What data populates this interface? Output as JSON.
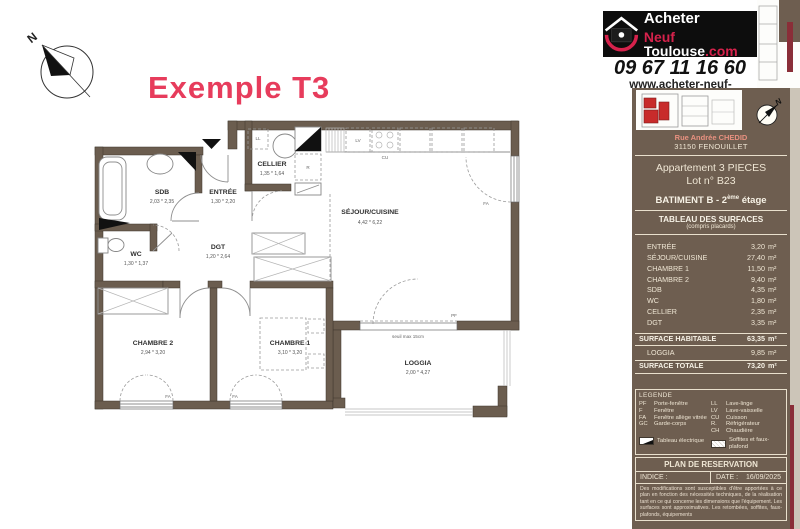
{
  "title": "Exemple T3",
  "colors": {
    "accent_pink": "#e73c5c",
    "logo_red": "#d6224c",
    "panel_brown": "#6e5e50",
    "wall_brown": "#6b5d4f",
    "maroon": "#8a2e38",
    "site_red": "#c82b2b"
  },
  "header": {
    "logo": {
      "line1": "Acheter",
      "line2_red": "Neuf",
      "line2_white": " Toulouse",
      "line2_suffix": ".com"
    },
    "phone": "09 67 11 16 60",
    "website": "www.acheter-neuf-toulouse.com"
  },
  "panel": {
    "address_line1": "Rue Andrée CHEDID",
    "address_line2": "31150 FENOUILLET",
    "apartment_type": "Appartement 3 PIECES",
    "lot": "Lot n° B23",
    "building_prefix": "BATIMENT B - 2",
    "building_sup": "ème",
    "building_suffix": " étage",
    "surfaces_title": "TABLEAU DES SURFACES",
    "surfaces_subtitle": "(compris placards)",
    "rows": [
      {
        "label": "ENTRÉE",
        "value": "3,20",
        "unit": "m²"
      },
      {
        "label": "SÉJOUR/CUISINE",
        "value": "27,40",
        "unit": "m²"
      },
      {
        "label": "CHAMBRE 1",
        "value": "11,50",
        "unit": "m²"
      },
      {
        "label": "CHAMBRE 2",
        "value": "9,40",
        "unit": "m²"
      },
      {
        "label": "SDB",
        "value": "4,35",
        "unit": "m²"
      },
      {
        "label": "WC",
        "value": "1,80",
        "unit": "m²"
      },
      {
        "label": "CELLIER",
        "value": "2,35",
        "unit": "m²"
      },
      {
        "label": "DGT",
        "value": "3,35",
        "unit": "m²"
      }
    ],
    "habitable": {
      "label": "SURFACE HABITABLE",
      "value": "63,35",
      "unit": "m²"
    },
    "loggia_row": {
      "label": "LOGGIA",
      "value": "9,85",
      "unit": "m²"
    },
    "total": {
      "label": "SURFACE TOTALE",
      "value": "73,20",
      "unit": "m²"
    }
  },
  "legend": {
    "title": "LEGENDE",
    "col1": [
      {
        "abbr": "PF",
        "label": "Porte-fenêtre"
      },
      {
        "abbr": "F",
        "label": "Fenêtre"
      },
      {
        "abbr": "FA",
        "label": "Fenêtre allège vitrée"
      },
      {
        "abbr": "GC",
        "label": "Garde-corps"
      }
    ],
    "col2": [
      {
        "abbr": "LL",
        "label": "Lave-linge"
      },
      {
        "abbr": "LV",
        "label": "Lave-vaisselle"
      },
      {
        "abbr": "CU",
        "label": "Cuisson"
      },
      {
        "abbr": "R.",
        "label": "Réfrigérateur"
      },
      {
        "abbr": "CH",
        "label": "Chaudière"
      }
    ],
    "symbol1_label": "Tableau électrique",
    "symbol2_label": "Soffites et faux-plafond"
  },
  "reservation": {
    "title": "PLAN DE RESERVATION",
    "indice_label": "INDICE :",
    "date_label": "DATE :",
    "date_value": "16/09/2025",
    "disclaimer": "Des modifications sont susceptibles d'être apportées à ce plan en fonction des nécessités techniques, de la réalisation tant en ce qui concerne les dimensions que l'équipement. Les surfaces sont approximatives. Les retombées, soffites, faux-plafonds, équipements"
  },
  "plan": {
    "rooms": {
      "sdb": {
        "name": "SDB",
        "dims": "2,03 * 2,35"
      },
      "entree": {
        "name": "ENTRÉE",
        "dims": "1,30 * 2,20"
      },
      "cellier": {
        "name": "CELLIER",
        "dims": "1,35 * 1,64"
      },
      "wc": {
        "name": "WC",
        "dims": "1,30 * 1,37"
      },
      "dgt": {
        "name": "DGT",
        "dims": "1,20 * 2,64"
      },
      "sejour": {
        "name": "SÉJOUR/CUISINE",
        "dims": "4,42 * 6,22"
      },
      "chambre2": {
        "name": "CHAMBRE 2",
        "dims": "2,94 * 3,20"
      },
      "chambre1": {
        "name": "CHAMBRE 1",
        "dims": "3,10 * 3,20"
      },
      "loggia": {
        "name": "LOGGIA",
        "dims": "2,00 * 4,27"
      }
    },
    "annotations": {
      "seuil": "seuil max 15cm",
      "pf": "PF",
      "fa": "FA",
      "ll": "LL",
      "lv": "LV",
      "cu": "CU",
      "r": "R",
      "north": "N"
    }
  }
}
